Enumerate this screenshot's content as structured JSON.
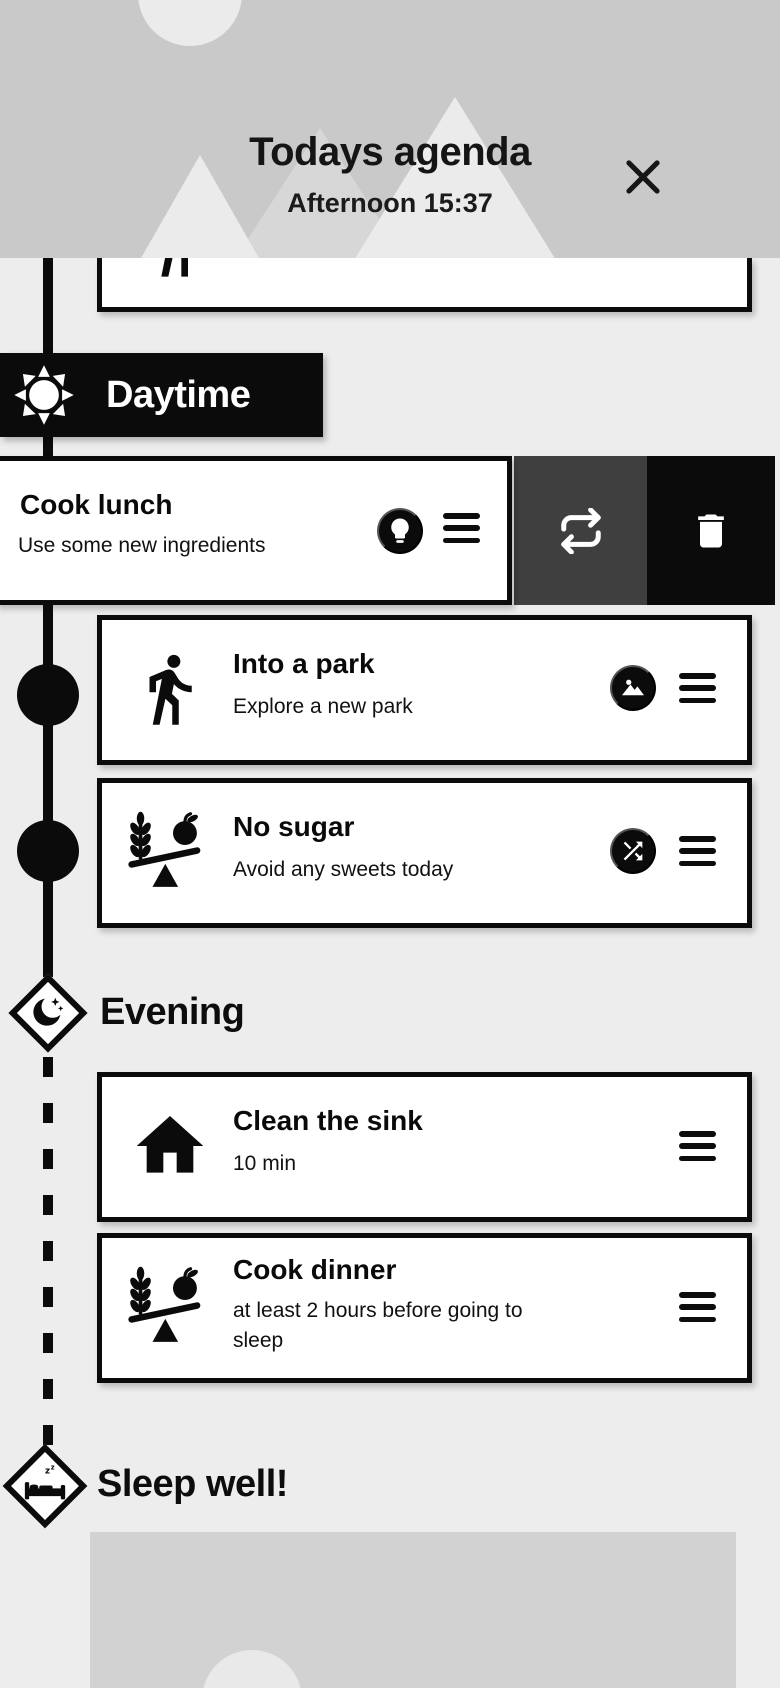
{
  "header": {
    "title": "Todays agenda",
    "subtitle": "Afternoon 15:37"
  },
  "sections": {
    "daytime": {
      "label": "Daytime",
      "icon": "sun-icon"
    },
    "evening": {
      "label": "Evening",
      "icon": "moon-icon"
    },
    "sleep": {
      "label": "Sleep well!",
      "icon": "bed-icon"
    }
  },
  "tasks": {
    "cook_lunch": {
      "title": "Cook lunch",
      "subtitle": "Use some new ingredients",
      "badge": "lightbulb-icon",
      "swipe_actions": [
        "swap",
        "delete"
      ]
    },
    "into_park": {
      "title": "Into a park",
      "subtitle": "Explore a new park",
      "icon": "walk-icon",
      "badge": "park-icon"
    },
    "no_sugar": {
      "title": "No sugar",
      "subtitle": "Avoid any sweets today",
      "icon": "scale-icon",
      "badge": "shuffle-icon"
    },
    "clean_sink": {
      "title": "Clean the sink",
      "subtitle": "10 min",
      "icon": "home-icon"
    },
    "cook_dinner": {
      "title": "Cook dinner",
      "subtitle": "at least 2 hours before going to sleep",
      "icon": "scale-icon"
    }
  },
  "colors": {
    "page_bg": "#ededed",
    "header_bg": "#c9c9c9",
    "decor_light": "#ebebeb",
    "decor_mid": "#d7d7d7",
    "black": "#0b0b0b",
    "action_gray": "#3f3f3f",
    "card_bg": "#ffffff",
    "preview_bg": "#d2d2d2",
    "preview_circle": "#e9e9e9"
  }
}
